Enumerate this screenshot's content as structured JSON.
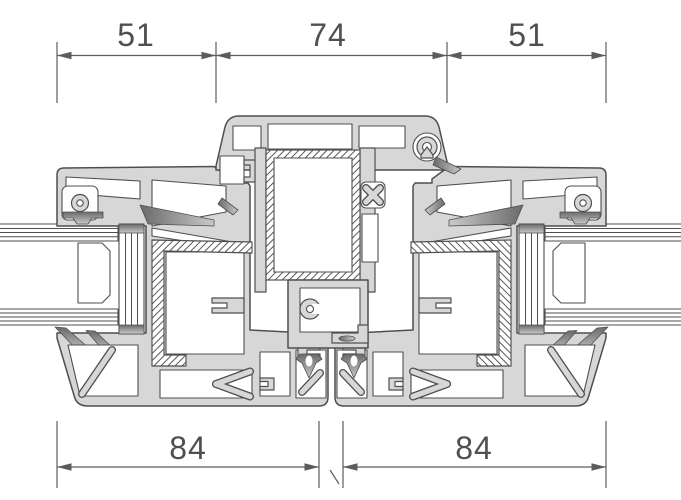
{
  "drawing": {
    "subject": "Window profile cross-section — two sashes meeting at center mullion (stulp)",
    "dimensions": {
      "top": [
        "51",
        "74",
        "51"
      ],
      "bottom": [
        "84",
        "84"
      ]
    },
    "colors": {
      "background": "#ffffff",
      "profile_fill": "#d7d7d7",
      "outline": "#4f4f4f",
      "dimension_lines": "#5c5c5c",
      "gasket_dark": "#666666",
      "gasket_light": "#c9c9c9",
      "steel_hatch": "#585858"
    }
  }
}
